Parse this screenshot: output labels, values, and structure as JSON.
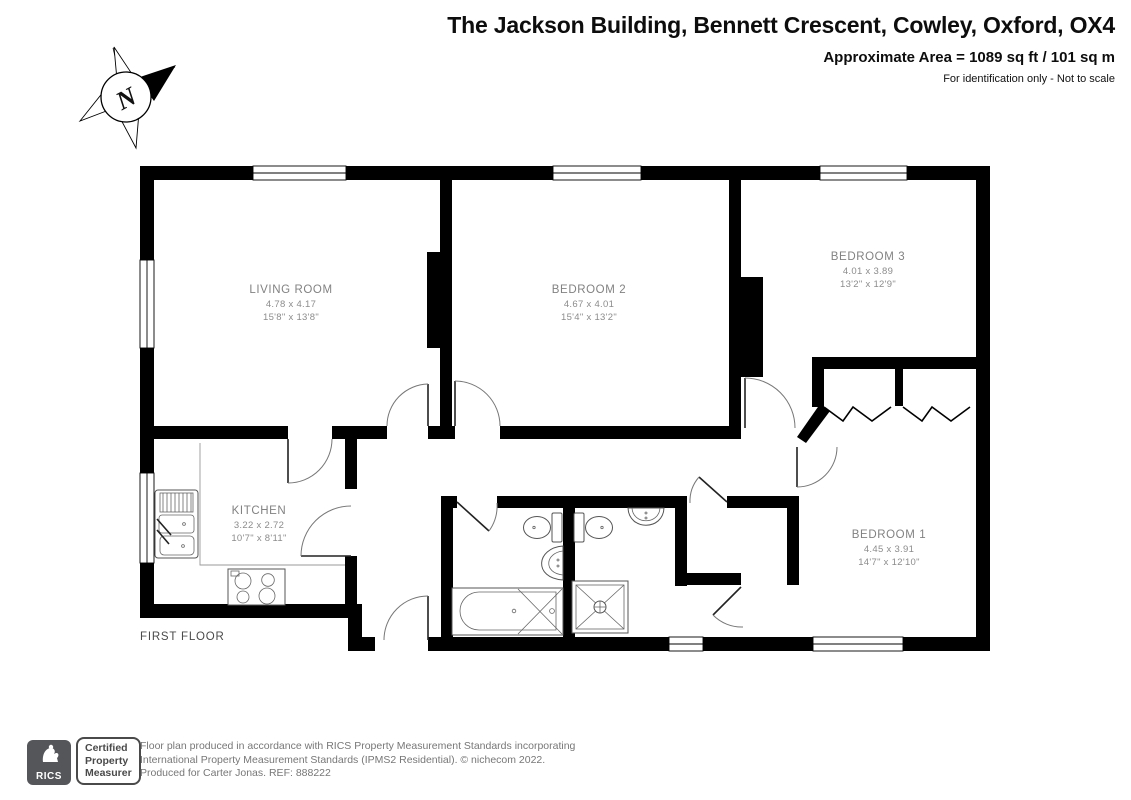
{
  "header": {
    "title": "The Jackson Building, Bennett Crescent, Cowley, Oxford, OX4",
    "area_line": "Approximate Area = 1089 sq ft / 101 sq m",
    "disclaimer": "For identification only - Not to scale"
  },
  "compass": {
    "label": "N"
  },
  "plan": {
    "floor_label": "FIRST FLOOR",
    "rooms": [
      {
        "name": "LIVING ROOM",
        "metric": "4.78 x 4.17",
        "imperial": "15'8\" x 13'8\""
      },
      {
        "name": "BEDROOM 2",
        "metric": "4.67 x 4.01",
        "imperial": "15'4\" x 13'2\""
      },
      {
        "name": "BEDROOM 3",
        "metric": "4.01 x 3.89",
        "imperial": "13'2\" x 12'9\""
      },
      {
        "name": "BEDROOM 1",
        "metric": "4.45 x 3.91",
        "imperial": "14'7\" x 12'10\""
      },
      {
        "name": "KITCHEN",
        "metric": "3.22 x 2.72",
        "imperial": "10'7\" x 8'11\""
      }
    ],
    "wall_color": "#000000",
    "label_color": "#828282"
  },
  "footer": {
    "rics_logo_text": "RICS",
    "badge_lines": [
      "Certified",
      "Property",
      "Measurer"
    ],
    "credit_lines": [
      "Floor plan produced in accordance with RICS Property Measurement Standards incorporating",
      "International Property Measurement Standards (IPMS2 Residential).   © nichecom 2022.",
      "Produced for Carter Jonas.   REF:  888222"
    ]
  }
}
